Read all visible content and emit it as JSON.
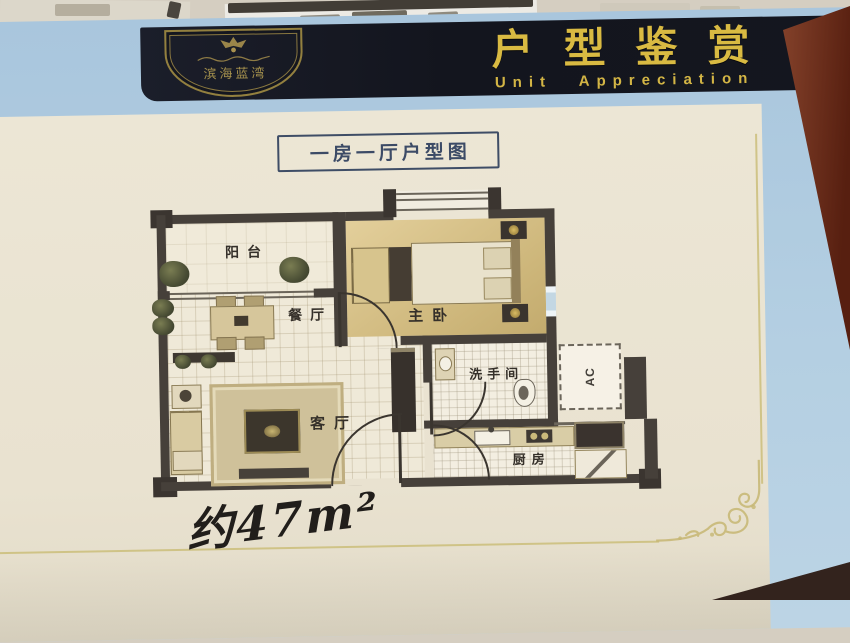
{
  "header": {
    "logo": {
      "emblem_icon": "crest-icon",
      "name": "滨海蓝湾"
    },
    "title_cn": "户型鉴赏",
    "title_en": "Unit Appreciation"
  },
  "card": {
    "plan_title": "一房一厅户型图",
    "rooms": [
      {
        "label": "阳台"
      },
      {
        "label": "餐厅"
      },
      {
        "label": "主卧"
      },
      {
        "label": "客厅"
      },
      {
        "label": "洗手间"
      },
      {
        "label": "厨房"
      },
      {
        "label": "AC"
      }
    ],
    "area_note": "约47m²"
  },
  "colors": {
    "header_bg": "#14161f",
    "gold_text": "#d9ba42",
    "page_blue": "#aec9de",
    "card_cream": "#ebe5d4",
    "wall": "#46403a",
    "frame_gold": "#c9bb74",
    "desk_brown": "#78391f"
  }
}
